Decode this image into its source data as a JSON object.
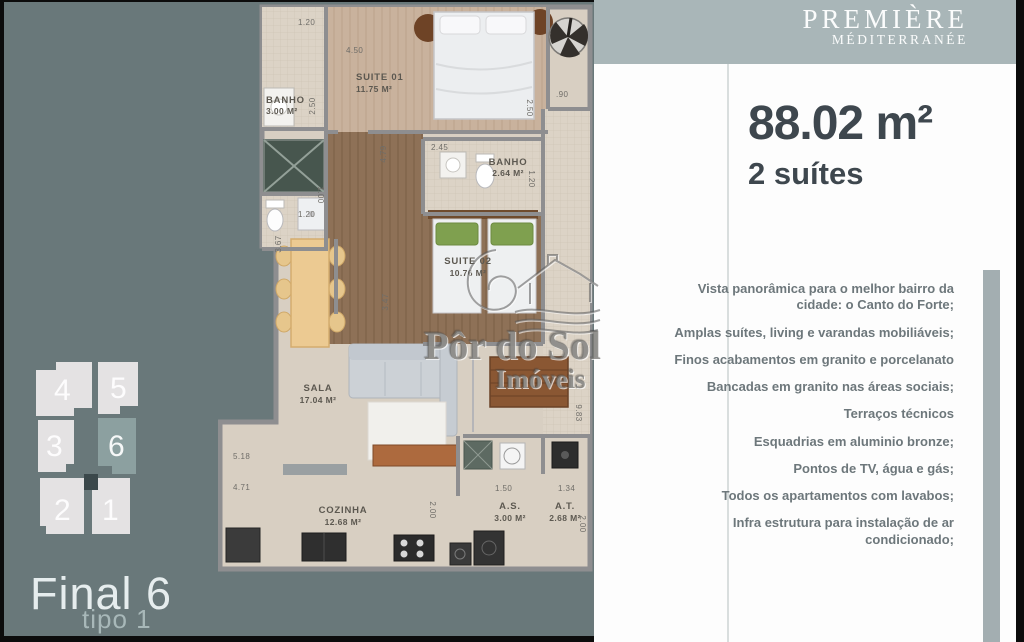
{
  "colors": {
    "slate": "#69787a",
    "band": "#a9b6b8",
    "unit_light": "#e4e2e3",
    "unit_hi": "#8ca0a0",
    "core": "#3b484b",
    "headline": "#3e474e",
    "feature_text": "#6d777b",
    "side_bar": "#a3aeb1",
    "frame": "#0c0c0c"
  },
  "sidebar": {
    "units": [
      "4",
      "5",
      "3",
      "6",
      "2",
      "1"
    ],
    "highlighted_unit": "6",
    "final_label": "Final 6",
    "type_label": "tipo 1"
  },
  "brand": {
    "line1": "PREMIÈRE",
    "line2": "MÉDITERRANÉE"
  },
  "summary": {
    "area": "88.02 m²",
    "suites": "2 suítes"
  },
  "features": [
    "Vista panorâmica para o melhor bairro da cidade: o Canto do Forte;",
    "Amplas suítes, living e varandas mobiliáveis;",
    "Finos acabamentos em granito e porcelanato",
    "Bancadas em granito nas áreas sociais;",
    "Terraços técnicos",
    "Esquadrias em aluminio bronze;",
    "Pontos de TV, água e gás;",
    "Todos os apartamentos com lavabos;",
    "Infra estrutura para instalação de ar condicionado;"
  ],
  "watermark": {
    "line1": "Pôr do Sol",
    "line2": "Imóveis"
  },
  "plan": {
    "rooms": {
      "banho1_name": "BANHO",
      "banho1_area": "3.00 M²",
      "suite1_name": "SUITE 01",
      "suite1_area": "11.75 M²",
      "banho2_name": "BANHO",
      "banho2_area": "2.64 M²",
      "suite2_name": "SUITE 02",
      "suite2_area": "10.76 M²",
      "sala_name": "SALA",
      "sala_area": "17.04 M²",
      "cozinha_name": "COZINHA",
      "cozinha_area": "12.68 M²",
      "as_name": "A.S.",
      "as_area": "3.00 M²",
      "at_name": "A.T.",
      "at_area": "2.68 M²"
    },
    "dims": {
      "banho1_w": "1.20",
      "suite1_w": "4.50",
      "hall_w": ".90",
      "banho1_h": "2.50",
      "suite1_h": "2.50",
      "banho2_w": "2.45",
      "banho2_h": "1.20",
      "lavabo_h": "1.00",
      "lavabo_w": "1.20",
      "dining_h": "3.67",
      "hall_h": "4.79",
      "suite2_h": "3.47",
      "varanda_h": "9.83",
      "sala_w1": "5.18",
      "sala_w2": "4.71",
      "kitchen_h": "2.00",
      "as_w": "1.50",
      "at_w": "1.34",
      "at_h": "2.00"
    }
  }
}
